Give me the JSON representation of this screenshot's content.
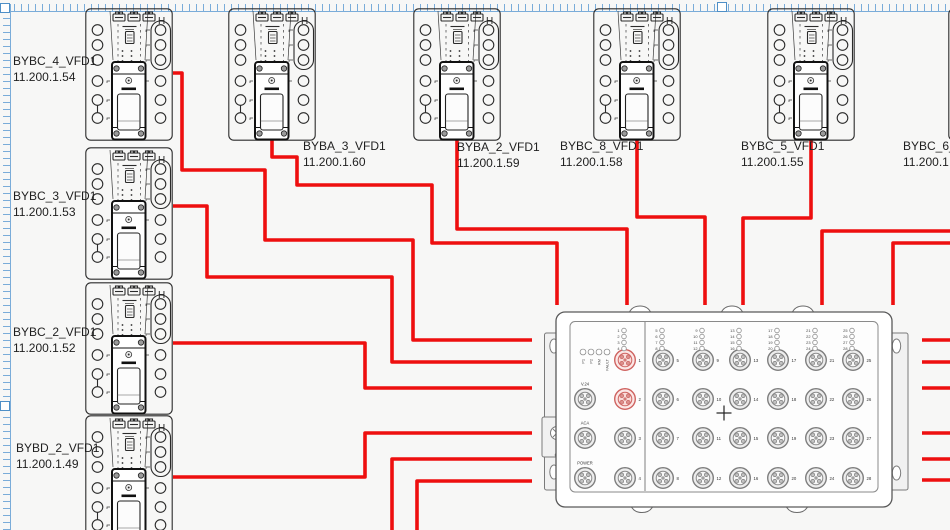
{
  "diagram": {
    "background": "#f7f7f6",
    "cable_color": "#ee0f0f",
    "selection_color": "#7aacd9",
    "selection_handles": [
      {
        "x": 0,
        "y": 3
      },
      {
        "x": 717,
        "y": 2
      },
      {
        "x": 0,
        "y": 401
      }
    ],
    "devices": [
      {
        "name": "BYBC_4_VFD1",
        "ip": "11.200.1.54",
        "x": 85,
        "y": 8,
        "label": {
          "x": 13,
          "y": 54
        }
      },
      {
        "name": "BYBC_3_VFD1",
        "ip": "11.200.1.53",
        "x": 85,
        "y": 147,
        "label": {
          "x": 13,
          "y": 189
        }
      },
      {
        "name": "BYBC_2_VFD1",
        "ip": "11.200.1.52",
        "x": 85,
        "y": 282,
        "label": {
          "x": 13,
          "y": 325
        }
      },
      {
        "name": "BYBD_2_VFD1",
        "ip": "11.200.1.49",
        "x": 85,
        "y": 415,
        "label": {
          "x": 16,
          "y": 441
        }
      },
      {
        "name": "BYBA_3_VFD1",
        "ip": "11.200.1.60",
        "x": 228,
        "y": 8,
        "label": {
          "x": 303,
          "y": 139
        }
      },
      {
        "name": "BYBA_2_VFD1",
        "ip": "11.200.1.59",
        "x": 413,
        "y": 8,
        "label": {
          "x": 457,
          "y": 140
        }
      },
      {
        "name": "BYBC_8_VFD1",
        "ip": "11.200.1.58",
        "x": 593,
        "y": 8,
        "label": {
          "x": 560,
          "y": 139
        }
      },
      {
        "name": "BYBC_5_VFD1",
        "ip": "11.200.1.55",
        "x": 767,
        "y": 8,
        "label": {
          "x": 741,
          "y": 139
        }
      },
      {
        "name": "BYBC_6_",
        "ip": "11.200.1",
        "x": 948,
        "y": 8,
        "label": {
          "x": 903,
          "y": 139
        }
      }
    ],
    "switch": {
      "status_leds": [
        "P1",
        "P2",
        "RM",
        "FAULT"
      ],
      "special_ports": [
        "V.24",
        "ACA",
        "POWER"
      ],
      "port_columns": [
        [
          1,
          2,
          3,
          4
        ],
        [
          5,
          6,
          7,
          8
        ],
        [
          9,
          10,
          11,
          12
        ],
        [
          13,
          14,
          15,
          16
        ],
        [
          17,
          18,
          19,
          20
        ],
        [
          21,
          22,
          23,
          24
        ],
        [
          25,
          26,
          27,
          28
        ]
      ],
      "highlighted_ports": [
        1,
        2
      ],
      "port_highlight_color": "#cf6360"
    },
    "cables": [
      {
        "from": "BYBC_4_VFD1",
        "points": [
          [
            173,
            73
          ],
          [
            182,
            73
          ],
          [
            182,
            170
          ],
          [
            265,
            170
          ],
          [
            265,
            240
          ],
          [
            413,
            240
          ],
          [
            413,
            340
          ],
          [
            532,
            340
          ]
        ]
      },
      {
        "from": "BYBC_3_VFD1",
        "points": [
          [
            173,
            206
          ],
          [
            207,
            206
          ],
          [
            207,
            277
          ],
          [
            392,
            277
          ],
          [
            392,
            362
          ],
          [
            532,
            362
          ]
        ]
      },
      {
        "from": "BYBC_2_VFD1",
        "points": [
          [
            173,
            343
          ],
          [
            365,
            343
          ],
          [
            365,
            388
          ],
          [
            532,
            388
          ]
        ]
      },
      {
        "from": "BYBD_2_VFD1",
        "points": [
          [
            173,
            477
          ],
          [
            365,
            477
          ],
          [
            365,
            433
          ],
          [
            532,
            433
          ]
        ]
      },
      {
        "from": "bottom-left",
        "points": [
          [
            392,
            531
          ],
          [
            392,
            459
          ],
          [
            532,
            459
          ]
        ]
      },
      {
        "from": "bottom-right",
        "points": [
          [
            417,
            531
          ],
          [
            417,
            481
          ],
          [
            532,
            481
          ]
        ]
      },
      {
        "from": "BYBA_3_VFD1",
        "points": [
          [
            272,
            137
          ],
          [
            272,
            157
          ],
          [
            297,
            157
          ],
          [
            297,
            185
          ],
          [
            432,
            185
          ],
          [
            432,
            243
          ],
          [
            557,
            243
          ],
          [
            557,
            305
          ]
        ]
      },
      {
        "from": "BYBA_2_VFD1",
        "points": [
          [
            457,
            140
          ],
          [
            457,
            229
          ],
          [
            627,
            229
          ],
          [
            627,
            305
          ]
        ]
      },
      {
        "from": "BYBC_8_VFD1",
        "points": [
          [
            637,
            138
          ],
          [
            637,
            217
          ],
          [
            705,
            217
          ],
          [
            705,
            305
          ]
        ]
      },
      {
        "from": "BYBC_5_VFD1",
        "points": [
          [
            811,
            140
          ],
          [
            811,
            218
          ],
          [
            743,
            218
          ],
          [
            743,
            305
          ]
        ]
      },
      {
        "from": "right-edge-a",
        "points": [
          [
            951,
            231
          ],
          [
            822,
            231
          ],
          [
            822,
            305
          ]
        ]
      },
      {
        "from": "right-edge-b",
        "points": [
          [
            951,
            243
          ],
          [
            893,
            243
          ],
          [
            893,
            305
          ]
        ]
      },
      {
        "from": "stub-1",
        "points": [
          [
            922,
            340
          ],
          [
            951,
            340
          ]
        ]
      },
      {
        "from": "stub-2",
        "points": [
          [
            922,
            362
          ],
          [
            951,
            362
          ]
        ]
      },
      {
        "from": "stub-3",
        "points": [
          [
            922,
            388
          ],
          [
            951,
            388
          ]
        ]
      },
      {
        "from": "stub-4",
        "points": [
          [
            922,
            433
          ],
          [
            951,
            433
          ]
        ]
      },
      {
        "from": "stub-5",
        "points": [
          [
            922,
            459
          ],
          [
            951,
            459
          ]
        ]
      },
      {
        "from": "stub-6",
        "points": [
          [
            922,
            480
          ],
          [
            951,
            480
          ]
        ]
      }
    ]
  }
}
